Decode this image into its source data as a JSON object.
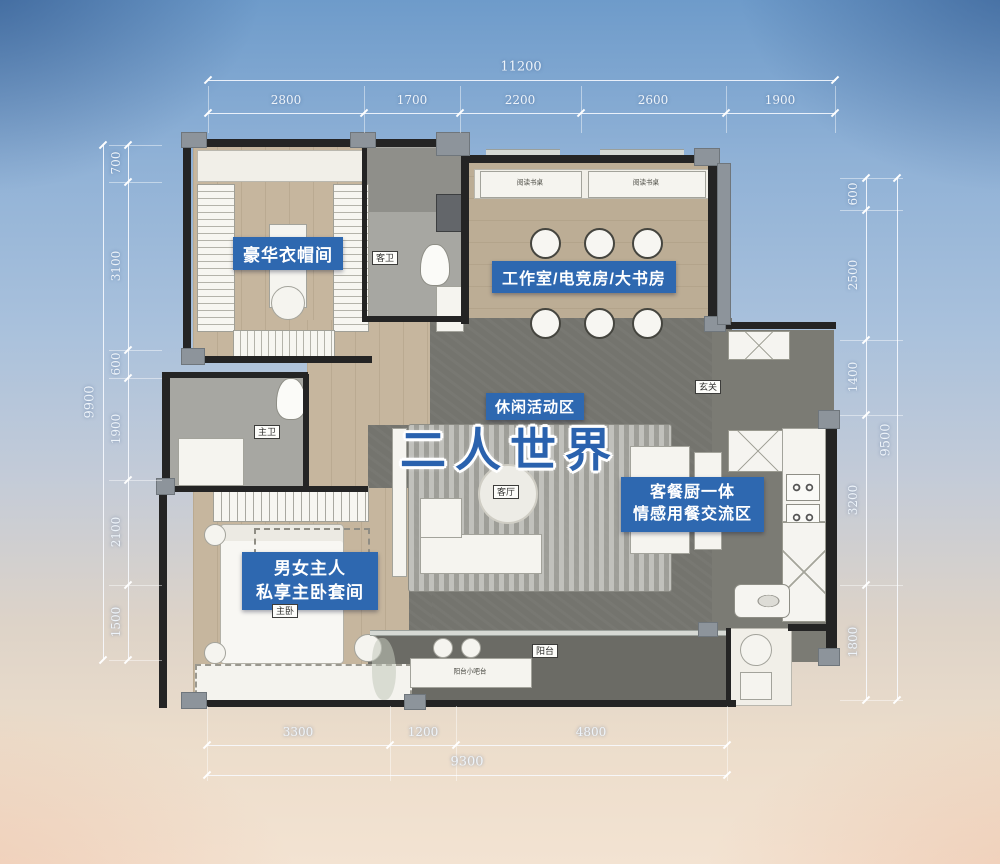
{
  "colors": {
    "badge_blue": "#2e68b0",
    "headline_blue": "#2a62ae",
    "wall_black": "#1c1c1c",
    "wood_floor": "#c6b69e",
    "dark_floor": "#74746e",
    "sky_top": "#6e9bca",
    "sky_bottom": "#f3e3d2"
  },
  "dims": {
    "top": {
      "total": "11200",
      "segments": [
        "2800",
        "1700",
        "2200",
        "2600",
        "1900"
      ]
    },
    "left": {
      "total": "9900",
      "segments": [
        "700",
        "3100",
        "600",
        "1900",
        "2100",
        "1500"
      ]
    },
    "right": {
      "total": "9500",
      "segments": [
        "600",
        "2500",
        "1400",
        "3200",
        "1800"
      ]
    },
    "bottom": {
      "total": "9300",
      "segments": [
        "3300",
        "1200",
        "4800"
      ]
    }
  },
  "badges": {
    "cloakroom": "豪华衣帽间",
    "study": "工作室/电竞房/大书房",
    "leisure": "休闲活动区",
    "dining_l1": "客餐厨一体",
    "dining_l2": "情感用餐交流区",
    "master_l1": "男女主人",
    "master_l2": "私享主卧套间"
  },
  "headline": "二人世界",
  "tags": {
    "guest_bath": "客卫",
    "master_bath": "主卫",
    "master_bed": "主卧",
    "living": "客厅",
    "entry": "玄关",
    "balcony": "阳台",
    "balcony_bar": "阳台小吧台",
    "reading_desk": "阅读书桌"
  }
}
